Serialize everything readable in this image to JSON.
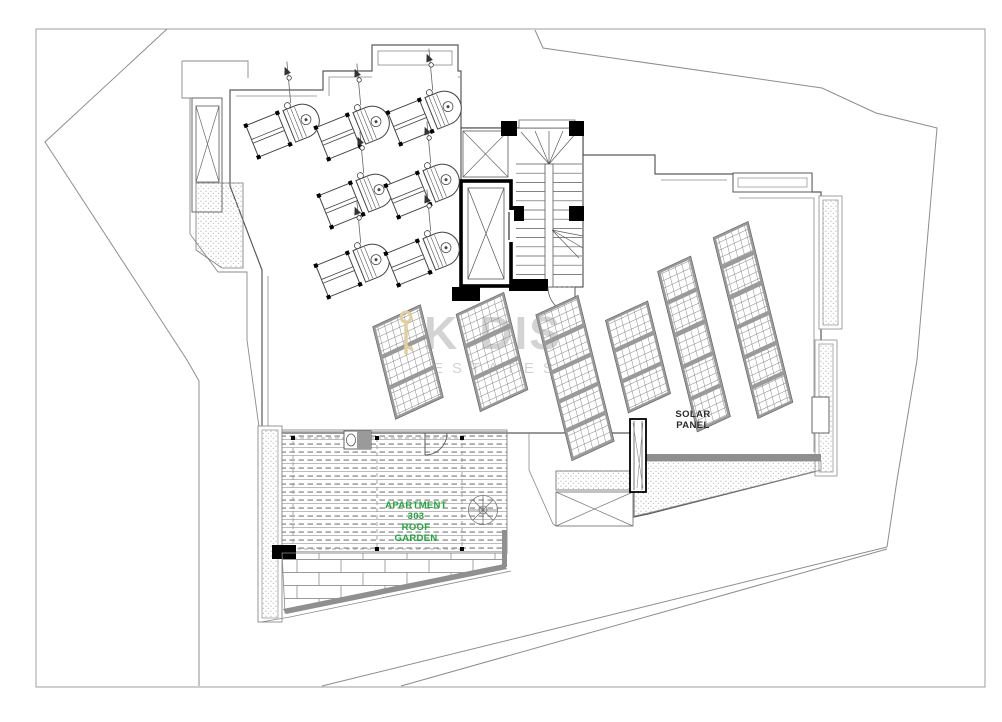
{
  "drawing": {
    "title": "Roof plan - Apartment 303 roof garden and solar panel roof",
    "labels": {
      "solar_panel_line1": "SOLAR",
      "solar_panel_line2": "PANEL",
      "apartment_line1": "APARTMENT",
      "apartment_line2": "303",
      "apartment_line3": "ROOF",
      "apartment_line4": "GARDEN"
    },
    "watermark": {
      "name": "KODIS",
      "part1": "K",
      "part2": "DIS",
      "subtitle": "ESTATES"
    },
    "colors": {
      "label_green": "#23a43c",
      "line_dark": "#4a4a4a",
      "line_mid": "#8a8a8a",
      "panel_band_gray": "#9a9a9a",
      "poche_black": "#000000",
      "parapet_band": "#8f8f8f",
      "watermark_gray": "#bdbdbd",
      "watermark_beige": "#e2cfa0",
      "paper_white": "#ffffff"
    }
  }
}
